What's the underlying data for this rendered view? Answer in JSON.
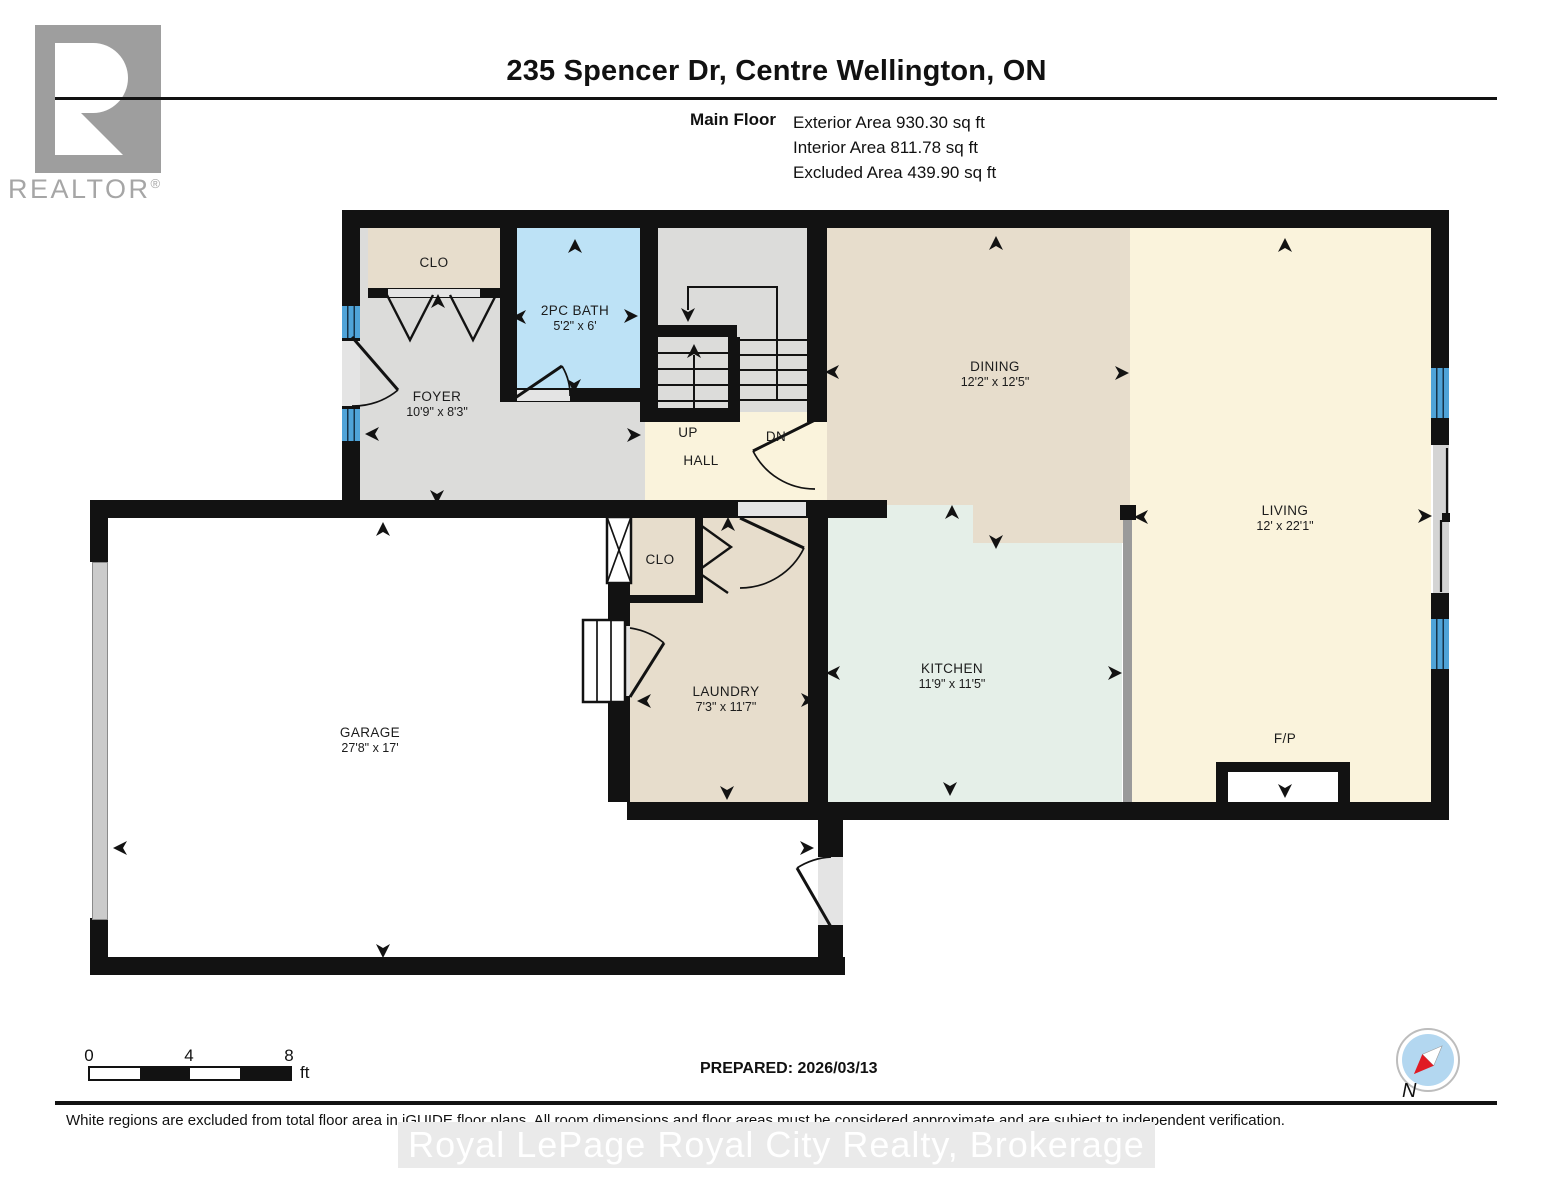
{
  "header": {
    "title": "235 Spencer Dr, Centre Wellington, ON",
    "floor_label": "Main Floor",
    "areas": [
      {
        "name": "Exterior Area",
        "value": "930.30 sq ft"
      },
      {
        "name": "Interior Area",
        "value": "811.78 sq ft"
      },
      {
        "name": "Excluded Area",
        "value": "439.90 sq ft"
      }
    ]
  },
  "logo": {
    "wordmark": "REALTOR",
    "registered": "®"
  },
  "rooms": {
    "clo1": {
      "label": "CLO"
    },
    "bath": {
      "label": "2PC BATH",
      "dims": "5'2\" x 6'"
    },
    "foyer": {
      "label": "FOYER",
      "dims": "10'9\" x 8'3\""
    },
    "up": {
      "label": "UP"
    },
    "dn": {
      "label": "DN"
    },
    "hall": {
      "label": "HALL"
    },
    "dining": {
      "label": "DINING",
      "dims": "12'2\" x 12'5\""
    },
    "living": {
      "label": "LIVING",
      "dims": "12' x 22'1\""
    },
    "kitchen": {
      "label": "KITCHEN",
      "dims": "11'9\" x 11'5\""
    },
    "laundry": {
      "label": "LAUNDRY",
      "dims": "7'3\" x 11'7\""
    },
    "clo2": {
      "label": "CLO"
    },
    "garage": {
      "label": "GARAGE",
      "dims": "27'8\" x 17'"
    },
    "fireplace": {
      "label": "F/P"
    }
  },
  "scale_bar": {
    "tick0": "0",
    "tick4": "4",
    "tick8": "8",
    "unit": "ft"
  },
  "footer": {
    "prepared": "PREPARED: 2026/03/13",
    "disclaimer": "White regions are excluded from total floor area in iGUIDE floor plans. All room dimensions and floor areas must be considered approximate and are subject to independent verification.",
    "watermark": "Royal LePage Royal City Realty, Brokerage",
    "compass_north": "N"
  },
  "colors": {
    "wall": "#121212",
    "beige": "#e7ddcc",
    "gray_floor": "#dcdcda",
    "cream": "#faf3dc",
    "mint": "#e5efe8",
    "bath_blue": "#bde2f6",
    "window_blue": "#4fa3d8",
    "half_wall": "#9a9a9a",
    "compass_red": "#e01b24"
  }
}
